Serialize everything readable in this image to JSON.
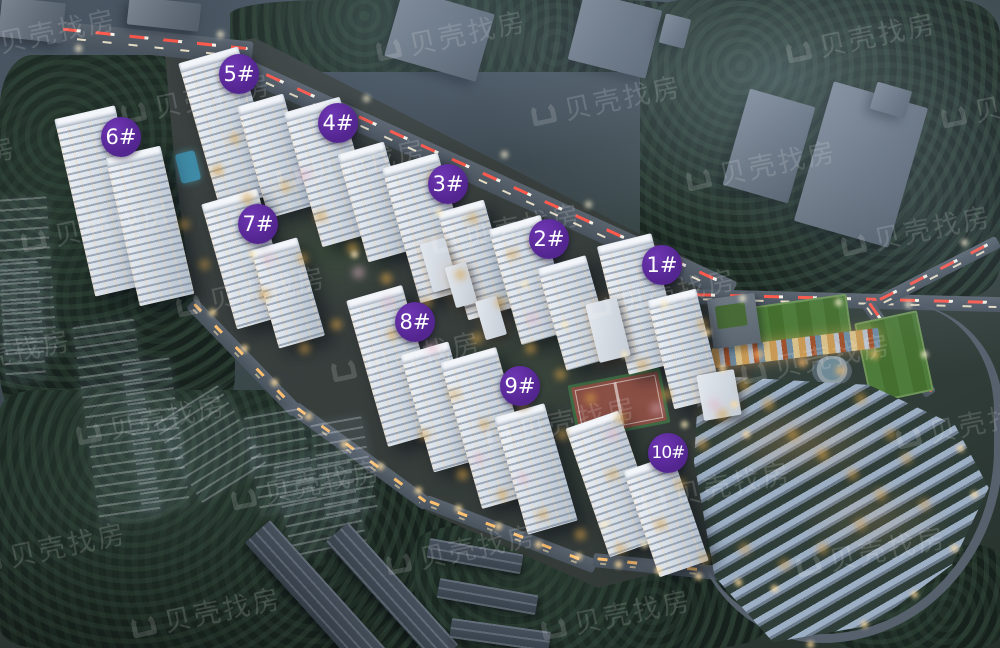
{
  "watermark": {
    "text": "贝壳找房",
    "icon": "beike-logo-icon",
    "color": "#ffffff"
  },
  "badges": [
    {
      "id": "building-1",
      "label": "1#"
    },
    {
      "id": "building-2",
      "label": "2#"
    },
    {
      "id": "building-3",
      "label": "3#"
    },
    {
      "id": "building-4",
      "label": "4#"
    },
    {
      "id": "building-5",
      "label": "5#"
    },
    {
      "id": "building-6",
      "label": "6#"
    },
    {
      "id": "building-7",
      "label": "7#"
    },
    {
      "id": "building-8",
      "label": "8#"
    },
    {
      "id": "building-9",
      "label": "9#"
    },
    {
      "id": "building-10",
      "label": "10#"
    }
  ],
  "colors": {
    "badge_bg": "#52258f",
    "badge_text": "#ffffff",
    "road_trail_red": "#ff5a4d",
    "road_trail_amber": "#ffc170",
    "field_green": "#4e7c3a",
    "court_red": "#8a4f45"
  }
}
